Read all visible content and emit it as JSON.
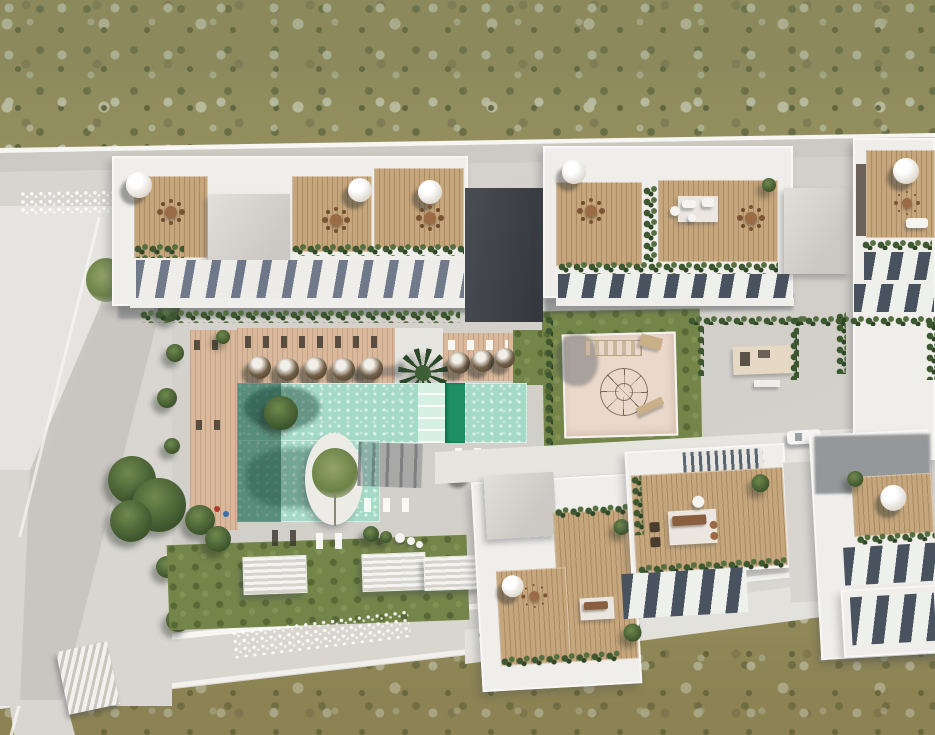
{
  "scene": {
    "type": "aerial-3d-render",
    "title": "Aerial render of residential complex with communal pool and gardens",
    "description": "Top-down architectural visualization: white apartment blocks with rooftop wood-deck terraces, parasols and solar panels around a landscaped courtyard with swimming pool, sun decks, circular tree island, children's playground, lawns and outdoor gym, bordered by an access road and olive scrubland.",
    "environment": {
      "setting": "scrubland",
      "lighting": "daylight, sun from upper right"
    },
    "palette": {
      "terrain_base": "#96905f",
      "terrain_sage": "#c7ccb3",
      "terrain_dark_scrub": "#545c36",
      "platform_concrete": "#d6d3cd",
      "path_light": "#e7e5e0",
      "road": "#d9d6d0",
      "roof_white": "#f0eeea",
      "roof_gray": "#d4d1cc",
      "shadow_gap": "#43474c",
      "wood_terrace": "#c6a67c",
      "pool_deck": "#d9b89c",
      "pool_water": "#a6dac8",
      "pool_shadow": "#2f6f5a",
      "pool_lane": "#1f8f68",
      "pool_steps": "#d6f0e4",
      "lawn": "#74854a",
      "hedge": "#3d5831",
      "playground_sand": "#ead8ca",
      "solar_panel": "#49525f",
      "parasol": "#f1efe9",
      "furniture_brown": "#8a5f3f"
    },
    "elements": {
      "buildings": [
        {
          "id": "north-west-block",
          "features": [
            "rooftop wood terraces",
            "dining sets",
            "parasols",
            "planter hedges",
            "louvered awnings"
          ]
        },
        {
          "id": "north-east-block",
          "features": [
            "rooftop wood terraces",
            "white lounge set",
            "dining set",
            "solar panels"
          ]
        },
        {
          "id": "east-block",
          "features": [
            "roof terrace",
            "parasol",
            "two solar panel rows"
          ]
        },
        {
          "id": "south-west-block",
          "features": [
            "L-shaped wood terrace",
            "parasol",
            "lounge furniture",
            "roof planting"
          ]
        },
        {
          "id": "south-center-block",
          "features": [
            "wood terrace",
            "lounge set on rug",
            "slatted pergola",
            "solar panels"
          ]
        },
        {
          "id": "south-east-block",
          "features": [
            "wood terrace",
            "parasol",
            "two solar panel rows",
            "cast shadow"
          ]
        }
      ],
      "amenities": [
        "swimming-pool",
        "sun-shelf-steps",
        "dark-lap-lane",
        "circular-island-with-tree",
        "north-sun-deck",
        "west-sun-deck",
        "sun-lounger-rows",
        "parasol-row",
        "palm-tree",
        "children-playground-sand",
        "climbing-net",
        "climbing-frame",
        "playground-lawn",
        "outdoor-gym-mat",
        "garden-lawn",
        "striped-planter-boxes",
        "topiary-balls",
        "pergola-shadow"
      ],
      "surroundings": [
        "olive-scrubland",
        "perimeter-access-road",
        "ornamental-paving-pattern",
        "neighbouring-stepped-roofs",
        "garden-trees",
        "exterior-staircase",
        "white-car"
      ]
    },
    "counts": {
      "parasols_pool_deck": 5,
      "dark_parasols": 5,
      "striped_planters": 3,
      "solar_panel_rows": 6
    }
  }
}
